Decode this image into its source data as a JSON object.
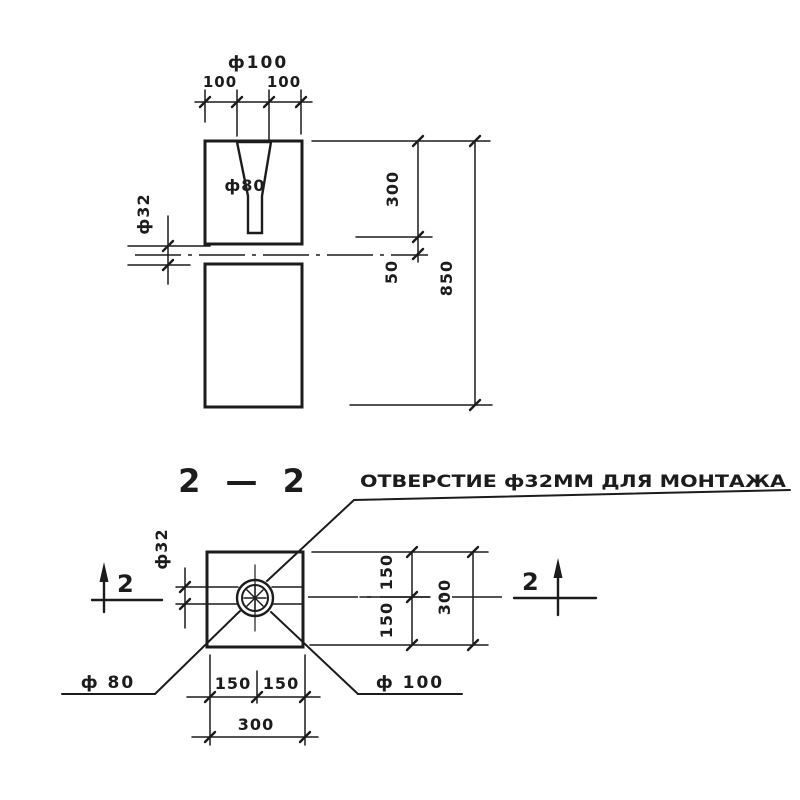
{
  "page": {
    "background": "#ffffff",
    "ink": "#1c1c1c"
  },
  "elevation_view": {
    "dim_top_diameter": "ф100",
    "dim_top_left": "100",
    "dim_top_right": "100",
    "hole_label": "ф80",
    "dim_hole_side": "ф32",
    "dim_right_upper": "300",
    "dim_right_mid": "50",
    "dim_right_total": "850"
  },
  "plan_view": {
    "section_title": "2 — 2",
    "annotation": "ОТВЕРСТИЕ ф32ММ ДЛЯ МОНТАЖА",
    "dim_hole_side": "ф32",
    "dim_right_top": "150",
    "dim_right_bottom": "150",
    "dim_right_total": "300",
    "dim_bottom_left": "150",
    "dim_bottom_right": "150",
    "dim_bottom_total": "300",
    "leader_label_80": "ф 80",
    "leader_label_100": "ф 100",
    "section_marker_left": "2",
    "section_marker_right": "2"
  }
}
